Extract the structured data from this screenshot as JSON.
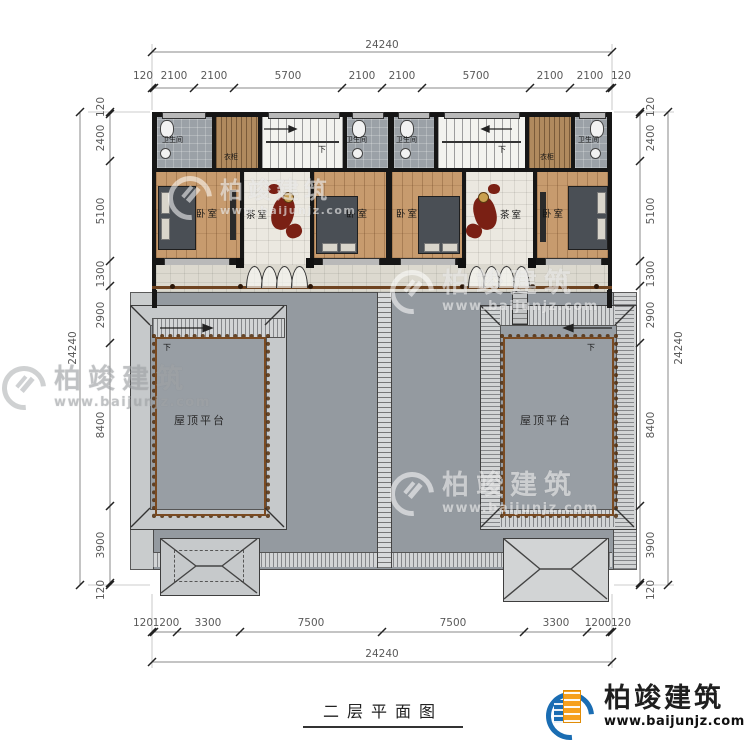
{
  "title": {
    "text": "二层平面图"
  },
  "rooms": {
    "bedroom": "卧室",
    "tearoom": "茶室",
    "bathroom": "卫生间",
    "wardrobe": "衣柜",
    "roof_terrace": "屋顶平台",
    "down": "下"
  },
  "dims": {
    "top": {
      "total": "24240",
      "segments": [
        "120",
        "2100",
        "2100",
        "5700",
        "2100",
        "2100",
        "5700",
        "2100",
        "2100",
        "120"
      ]
    },
    "bottom": {
      "total": "24240",
      "segments": [
        "120",
        "1200",
        "3300",
        "7500",
        "7500",
        "3300",
        "1200",
        "120"
      ]
    },
    "left": {
      "total": "24240",
      "segments": [
        "120",
        "2400",
        "5100",
        "1300",
        "2900",
        "8400",
        "3900",
        "120"
      ]
    },
    "right": {
      "total": "24240",
      "segments": [
        "120",
        "2400",
        "5100",
        "1300",
        "2900",
        "8400",
        "3900",
        "120"
      ]
    }
  },
  "watermark": {
    "name": "柏竣建筑",
    "url": "www.baijunjz.com"
  },
  "logo": {
    "name": "柏竣建筑",
    "url": "www.baijunjz.com"
  },
  "colors": {
    "wall": "#161616",
    "terrace_gray": "#949aa0",
    "railing_brown": "#7a4a21",
    "wood_floor": "#c79b6e",
    "carving_red": "#7a2014",
    "logo_blue": "#1a6db3",
    "logo_orange": "#f6a01d"
  }
}
